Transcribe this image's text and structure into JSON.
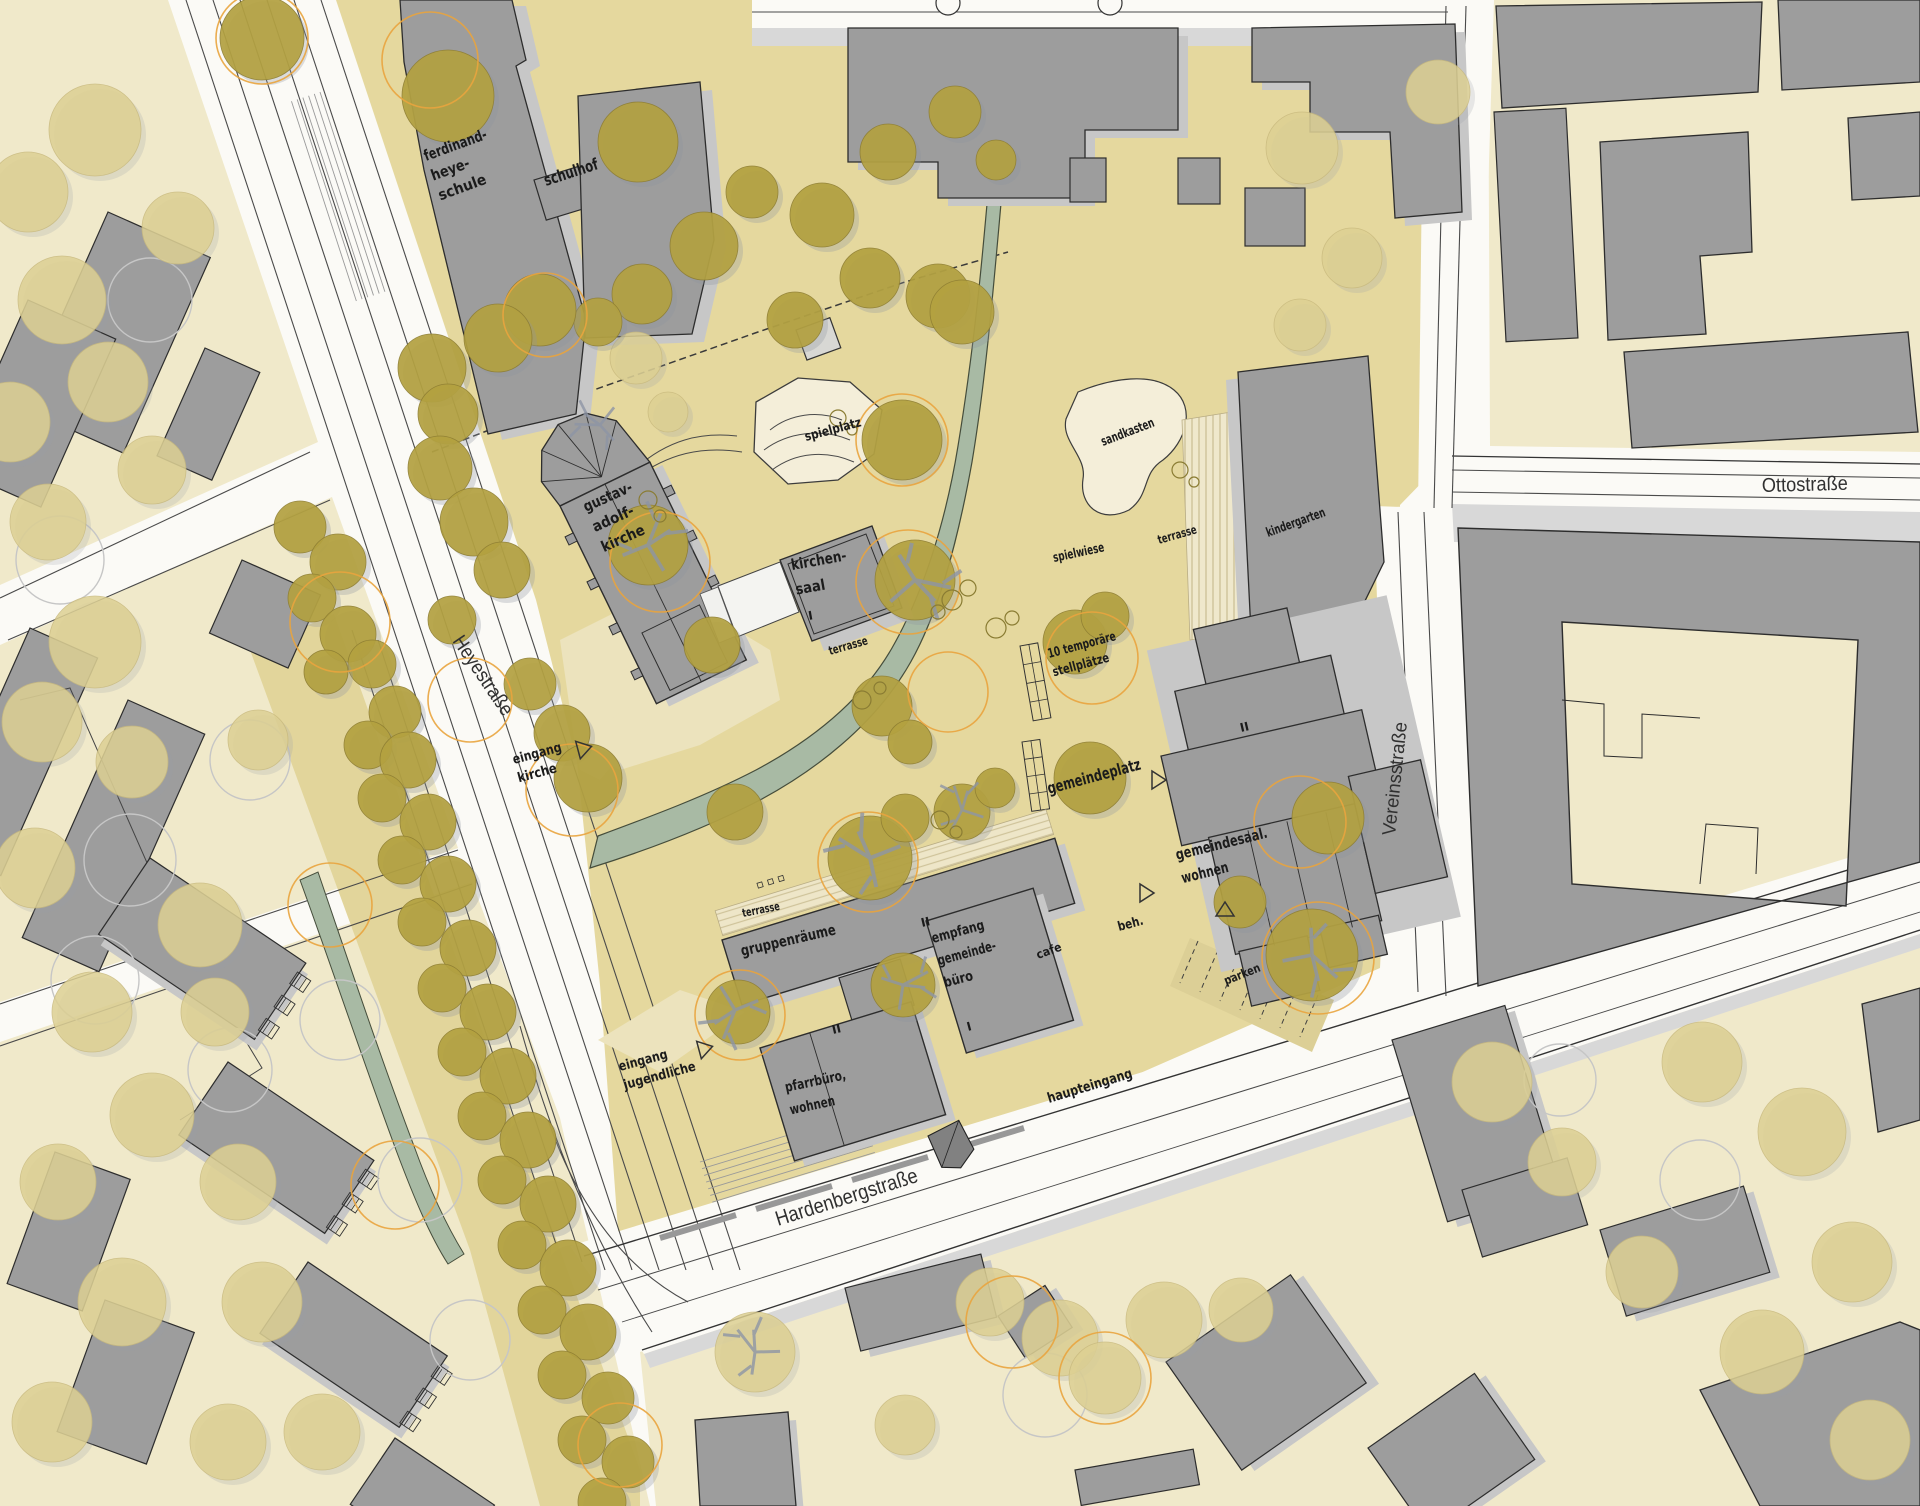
{
  "map": {
    "kind": "architectural site plan (figure-ground urban plan)",
    "streets": [
      "Heyestraße",
      "Ottostraße",
      "Vereinsstraße",
      "Hardenbergstraße"
    ]
  },
  "palette": {
    "street_white": "#fbfaf6",
    "block_beige": "#f0e9ca",
    "site_beige": "#e5d89e",
    "median_beige": "#e2d59b",
    "building_gray": "#9d9d9d",
    "building_outline": "#2d2d2d",
    "shadow_gray": "#c7c7c7",
    "white_building": "#f4f4f1",
    "light_area": "#f4eed9",
    "stripe_line": "#cfc39a",
    "curb_gray": "#d8d8d8",
    "stream_green": "#a8baa4",
    "stream_edge": "#454d3b",
    "tree_olive": "#b3a140",
    "tree_pale": "#ddd093",
    "ring_orange": "#e9a43e",
    "ring_gray": "#c6c6c6",
    "branch_gray": "#8d95a5",
    "label_color": "#1b1b1b"
  },
  "labels": [
    {
      "id": "ferdinand-heye-schule",
      "lines": [
        "ferdinand-",
        "heye-",
        "schule"
      ],
      "lens": [
        66,
        40,
        50
      ],
      "x": 426,
      "y": 161,
      "rot": -20,
      "size": 15,
      "lh": 21,
      "style": "site"
    },
    {
      "id": "schulhof",
      "lines": [
        "schulhof"
      ],
      "lens": [
        56
      ],
      "x": 546,
      "y": 186,
      "rot": -18,
      "size": 16,
      "lh": 20,
      "style": "site"
    },
    {
      "id": "spielplatz",
      "lines": [
        "spielplatz"
      ],
      "lens": [
        58
      ],
      "x": 806,
      "y": 441,
      "rot": -15,
      "size": 13,
      "lh": 16,
      "style": "site"
    },
    {
      "id": "gustav-adolf-kirche",
      "lines": [
        "gustav-",
        "adolf-",
        "kirche"
      ],
      "lens": [
        52,
        44,
        46
      ],
      "x": 586,
      "y": 512,
      "rot": -24,
      "size": 15,
      "lh": 22,
      "style": "site"
    },
    {
      "id": "kirchen-saal",
      "lines": [
        "kirchen-",
        "saal"
      ],
      "lens": [
        56,
        30
      ],
      "x": 792,
      "y": 570,
      "rot": -10,
      "size": 15,
      "lh": 25,
      "style": "site"
    },
    {
      "id": "level-I-kirchensaal",
      "lines": [
        "I"
      ],
      "x": 809,
      "y": 620,
      "rot": -10,
      "size": 12,
      "lh": 14,
      "style": "site"
    },
    {
      "id": "terrasse-kirchensaal",
      "lines": [
        "terrasse"
      ],
      "lens": [
        40
      ],
      "x": 830,
      "y": 655,
      "rot": -16,
      "size": 12,
      "lh": 14,
      "style": "site"
    },
    {
      "id": "sandkasten",
      "lines": [
        "sandkasten"
      ],
      "lens": [
        56
      ],
      "x": 1103,
      "y": 446,
      "rot": -21,
      "size": 13,
      "lh": 16,
      "style": "site"
    },
    {
      "id": "spielwiese",
      "lines": [
        "spielwiese"
      ],
      "lens": [
        52
      ],
      "x": 1054,
      "y": 562,
      "rot": -12,
      "size": 13,
      "lh": 16,
      "style": "site"
    },
    {
      "id": "terrasse-kindergarten",
      "lines": [
        "terrasse"
      ],
      "lens": [
        40
      ],
      "x": 1159,
      "y": 544,
      "rot": -16,
      "size": 12,
      "lh": 14,
      "style": "site"
    },
    {
      "id": "kindergarten",
      "lines": [
        "kindergarten"
      ],
      "lens": [
        62
      ],
      "x": 1268,
      "y": 537,
      "rot": -20,
      "size": 13,
      "lh": 16,
      "style": "site"
    },
    {
      "id": "eingang-kirche",
      "lines": [
        "eingang",
        "kirche"
      ],
      "lens": [
        50,
        40
      ],
      "x": 514,
      "y": 764,
      "rot": -15,
      "size": 13.5,
      "lh": 19,
      "style": "site"
    },
    {
      "id": "zehn-temporaere-stellplaetze",
      "lines": [
        "10 temporäre",
        "stellplätze"
      ],
      "lens": [
        70,
        58
      ],
      "x": 1049,
      "y": 658,
      "rot": -15,
      "size": 13,
      "lh": 19,
      "style": "site"
    },
    {
      "id": "gemeindeplatz",
      "lines": [
        "gemeindeplatz"
      ],
      "lens": [
        96
      ],
      "x": 1049,
      "y": 794,
      "rot": -15,
      "size": 16,
      "lh": 20,
      "style": "site"
    },
    {
      "id": "gemeindesaal-wohnen",
      "lines": [
        "gemeindesaal.",
        "wohnen"
      ],
      "lens": [
        94,
        48
      ],
      "x": 1177,
      "y": 860,
      "rot": -14,
      "size": 15,
      "lh": 24,
      "style": "site"
    },
    {
      "id": "beh",
      "lines": [
        "beh."
      ],
      "lens": [
        26
      ],
      "x": 1119,
      "y": 931,
      "rot": -15,
      "size": 13,
      "lh": 16,
      "style": "site"
    },
    {
      "id": "terrasse-gruppenraeume",
      "lines": [
        "terrasse"
      ],
      "lens": [
        38
      ],
      "x": 743,
      "y": 917,
      "rot": -11,
      "size": 11.5,
      "lh": 14,
      "style": "site"
    },
    {
      "id": "gruppenraeume",
      "lines": [
        "gruppenräume"
      ],
      "lens": [
        97
      ],
      "x": 742,
      "y": 956,
      "rot": -13,
      "size": 15,
      "lh": 19,
      "style": "site"
    },
    {
      "id": "empfang-gemeindebuero",
      "lines": [
        "empfang",
        "gemeinde-",
        "büro"
      ],
      "lens": [
        54,
        60,
        30
      ],
      "x": 933,
      "y": 943,
      "rot": -15,
      "size": 14,
      "lh": 23,
      "style": "site"
    },
    {
      "id": "level-I-empfang",
      "lines": [
        "I"
      ],
      "x": 968,
      "y": 1031,
      "rot": -15,
      "size": 12,
      "lh": 14,
      "style": "site"
    },
    {
      "id": "level-II-gruppenraeume",
      "lines": [
        "II"
      ],
      "x": 922,
      "y": 927,
      "rot": -13,
      "size": 12,
      "lh": 14,
      "style": "site"
    },
    {
      "id": "level-II-gemeindesaal",
      "lines": [
        "II"
      ],
      "x": 1241,
      "y": 732,
      "rot": -13,
      "size": 12,
      "lh": 14,
      "style": "site"
    },
    {
      "id": "level-II-pfarrbuero",
      "lines": [
        "II"
      ],
      "x": 833,
      "y": 1034,
      "rot": -13,
      "size": 12,
      "lh": 14,
      "style": "site"
    },
    {
      "id": "cafe",
      "lines": [
        "cafe"
      ],
      "lens": [
        26
      ],
      "x": 1038,
      "y": 959,
      "rot": -20,
      "size": 12,
      "lh": 14,
      "style": "site"
    },
    {
      "id": "pfarrbuero-wohnen",
      "lines": [
        "pfarrbüro,",
        "wohnen"
      ],
      "lens": [
        62,
        46
      ],
      "x": 786,
      "y": 1092,
      "rot": -12,
      "size": 14,
      "lh": 23,
      "style": "site"
    },
    {
      "id": "eingang-jugendliche",
      "lines": [
        "eingang",
        "jugendliche"
      ],
      "lens": [
        50,
        74
      ],
      "x": 620,
      "y": 1071,
      "rot": -15,
      "size": 13.5,
      "lh": 19,
      "style": "site"
    },
    {
      "id": "haupteingang",
      "lines": [
        "haupteingang"
      ],
      "lens": [
        88
      ],
      "x": 1049,
      "y": 1103,
      "rot": -17,
      "size": 14,
      "lh": 17,
      "style": "site"
    },
    {
      "id": "parken",
      "lines": [
        "parken"
      ],
      "lens": [
        38
      ],
      "x": 1226,
      "y": 985,
      "rot": -22,
      "size": 12,
      "lh": 14,
      "style": "site"
    },
    {
      "id": "ottostrasse",
      "lines": [
        "Ottostraße"
      ],
      "lens": [
        86
      ],
      "x": 1762,
      "y": 492,
      "rot": -1.5,
      "size": 20,
      "lh": 22,
      "style": "street"
    },
    {
      "id": "heyestrasse",
      "lines": [
        "Heyestraße"
      ],
      "lens": [
        92
      ],
      "x": 452,
      "y": 641,
      "rot": 56,
      "size": 20,
      "lh": 22,
      "style": "street"
    },
    {
      "id": "vereinsstrasse",
      "lines": [
        "Vereinsstraße"
      ],
      "lens": [
        114
      ],
      "x": 1395,
      "y": 836,
      "rot": -84,
      "size": 19,
      "lh": 21,
      "style": "street"
    },
    {
      "id": "hardenbergstrasse",
      "lines": [
        "Hardenbergstraße"
      ],
      "lens": [
        148
      ],
      "x": 778,
      "y": 1226,
      "rot": -17.5,
      "size": 21,
      "lh": 23,
      "style": "street"
    }
  ],
  "markers": [
    {
      "id": "entrance-arrow-kirche",
      "x": 578,
      "y": 750,
      "rot": -15
    },
    {
      "id": "entrance-arrow-jugendliche",
      "x": 699,
      "y": 1050,
      "rot": -15
    },
    {
      "id": "entrance-arrow-beh",
      "x": 1140,
      "y": 893,
      "rot": 0
    },
    {
      "id": "entrance-arrow-gemeindeplatz",
      "x": 1152,
      "y": 780,
      "rot": 0
    },
    {
      "id": "gable-marker",
      "x": 1225,
      "y": 916,
      "rot": -90
    }
  ]
}
